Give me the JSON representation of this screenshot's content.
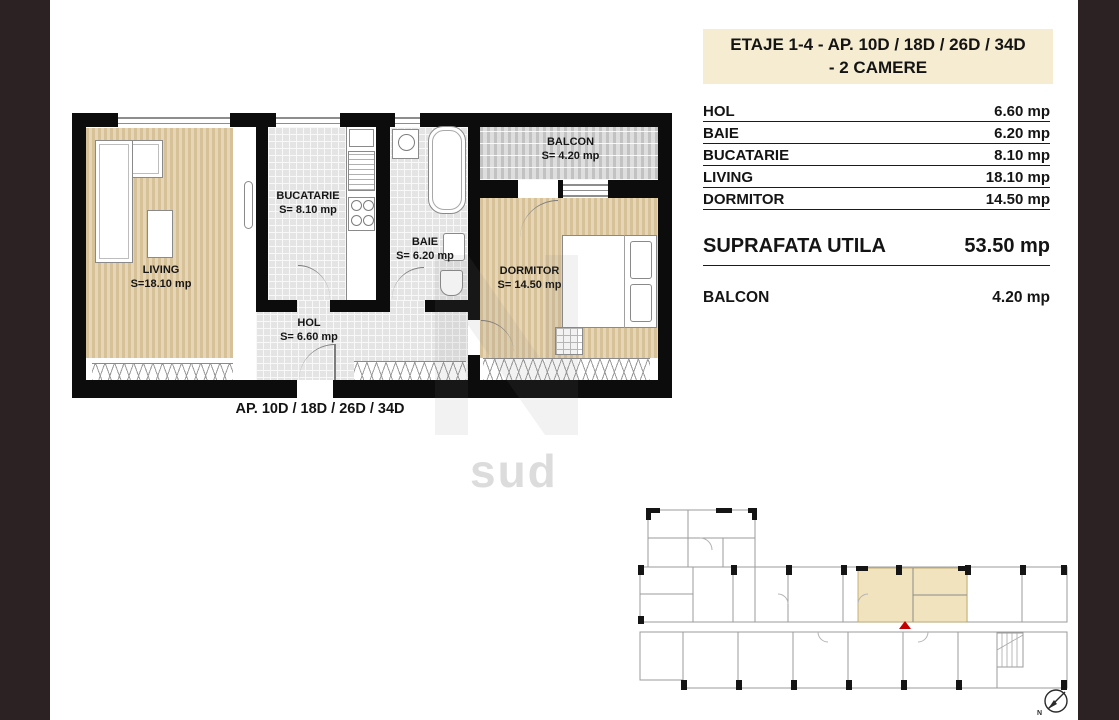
{
  "header": {
    "line1": "ETAJE 1-4 - AP.  10D / 18D / 26D / 34D",
    "line2": "- 2 CAMERE"
  },
  "areas": {
    "rows": [
      {
        "label": "HOL",
        "value": "6.60 mp"
      },
      {
        "label": "BAIE",
        "value": "6.20 mp"
      },
      {
        "label": "BUCATARIE",
        "value": "8.10 mp"
      },
      {
        "label": "LIVING",
        "value": "18.10 mp"
      },
      {
        "label": "DORMITOR",
        "value": "14.50 mp"
      }
    ],
    "total_label": "SUPRAFATA UTILA",
    "total_value": "53.50 mp",
    "balcony_label": "BALCON",
    "balcony_value": "4.20 mp"
  },
  "plan": {
    "caption": "AP.  10D / 18D / 26D / 34D",
    "rooms": {
      "living": {
        "name": "LIVING",
        "area": "S=18.10 mp"
      },
      "bucatarie": {
        "name": "BUCATARIE",
        "area": "S= 8.10 mp"
      },
      "baie": {
        "name": "BAIE",
        "area": "S= 6.20 mp"
      },
      "hol": {
        "name": "HOL",
        "area": "S= 6.60 mp"
      },
      "dormitor": {
        "name": "DORMITOR",
        "area": "S= 14.50 mp"
      },
      "balcon": {
        "name": "BALCON",
        "area": "S= 4.20 mp"
      }
    }
  },
  "watermark": {
    "text": "sud"
  },
  "key_plan": {
    "north_label": "N"
  },
  "colors": {
    "frame_brown": "#2c2123",
    "header_cream": "#f5ecd2",
    "floor_wood": "#d9c49c",
    "floor_tile": "#e4e4e4",
    "balcony_gray": "#cfcfcf",
    "highlight_beige": "#f1e3bd",
    "marker_red": "#c40000"
  }
}
